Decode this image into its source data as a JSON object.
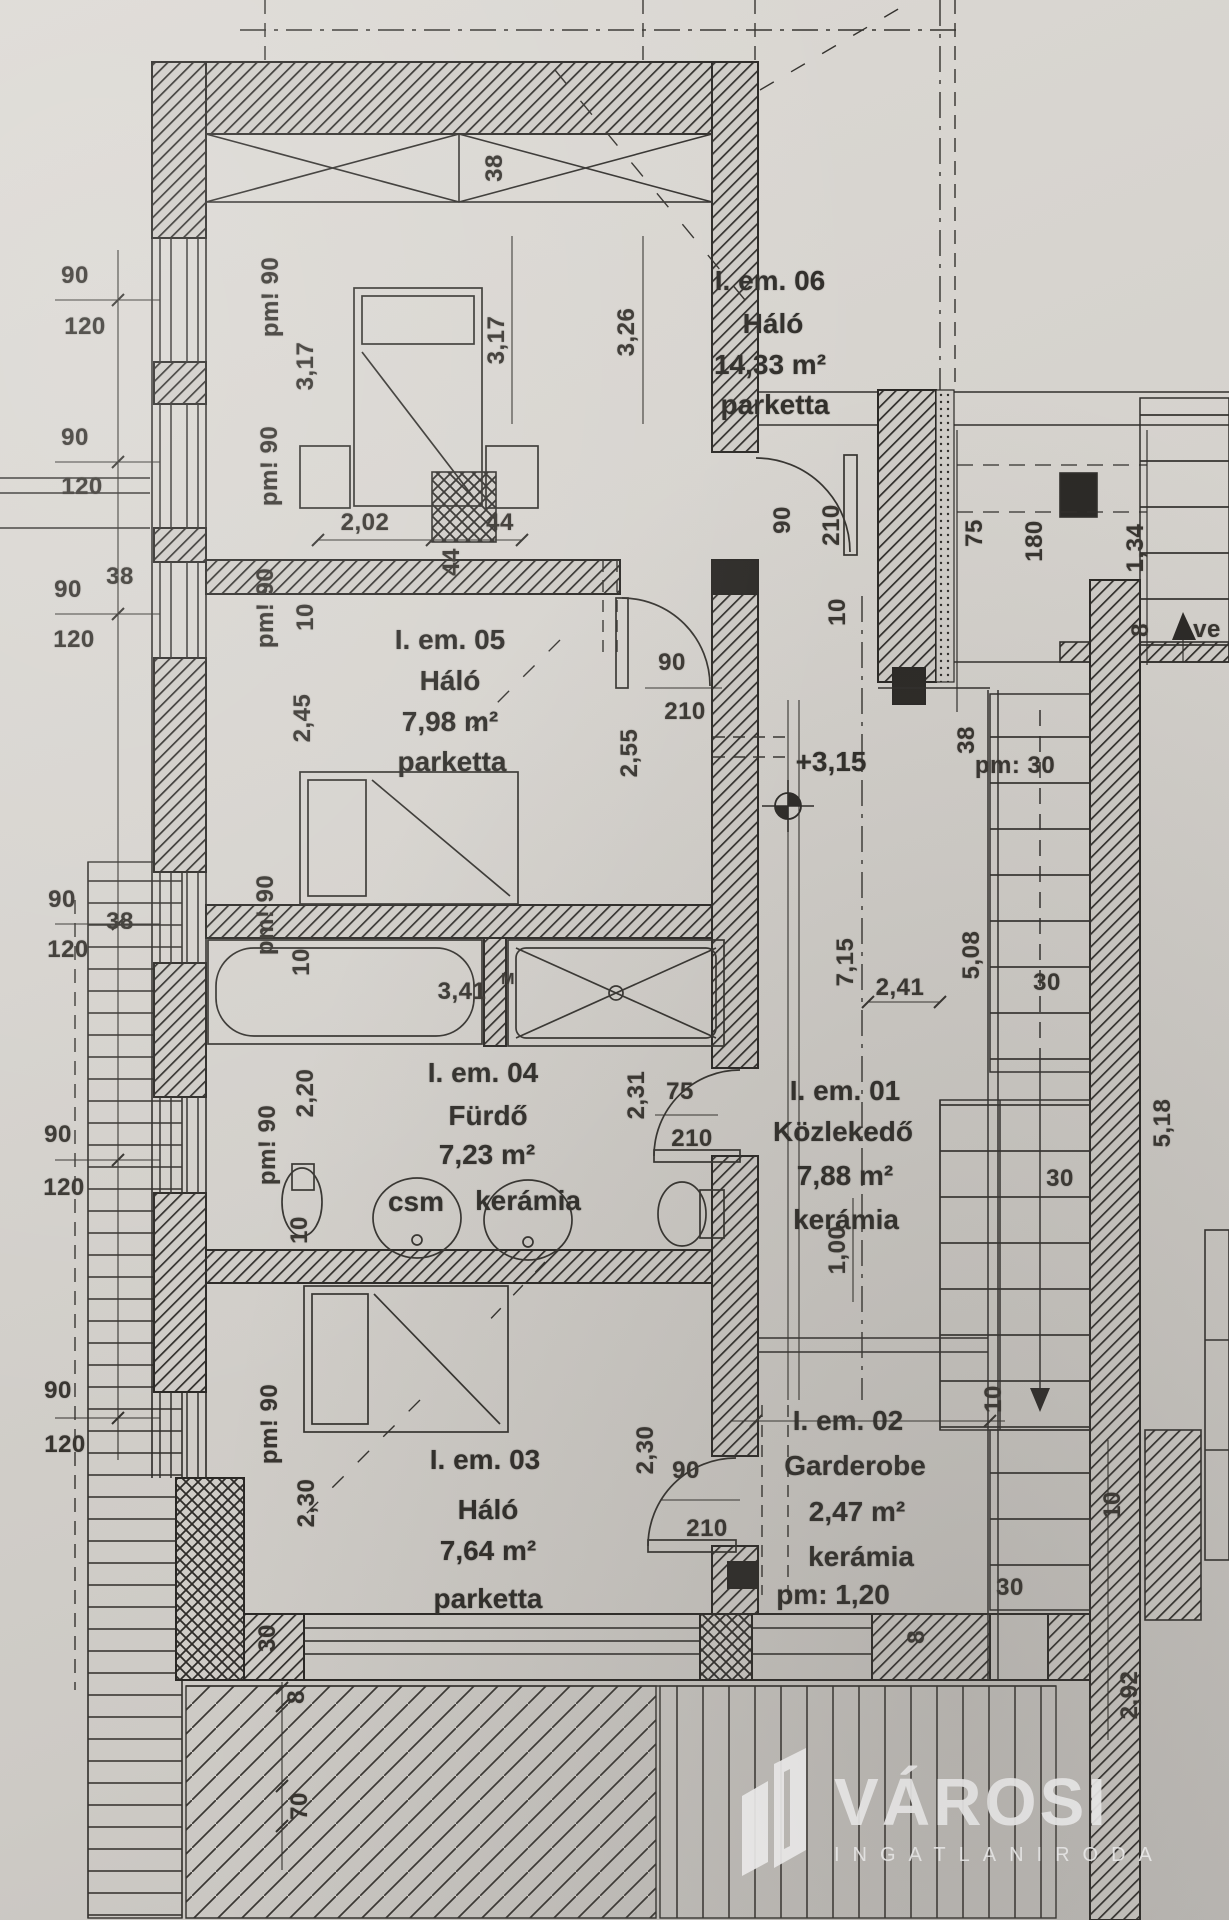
{
  "rooms": [
    {
      "id": "I. em. 06",
      "name": "Háló",
      "area": "14,33 m²",
      "floor": "parketta"
    },
    {
      "id": "I. em. 05",
      "name": "Háló",
      "area": "7,98 m²",
      "floor": "parketta"
    },
    {
      "id": "I. em. 04",
      "name": "Fürdő",
      "area": "7,23 m²",
      "floor": "kerámia",
      "fixture": "csm"
    },
    {
      "id": "I. em. 01",
      "name": "Közlekedő",
      "area": "7,88 m²",
      "floor": "kerámia"
    },
    {
      "id": "I. em. 02",
      "name": "Garderobe",
      "area": "2,47 m²",
      "floor": "kerámia",
      "note": "pm: 1,20"
    },
    {
      "id": "I. em. 03",
      "name": "Háló",
      "area": "7,64 m²",
      "floor": "parketta"
    }
  ],
  "level_mark": "+3,15",
  "dims": {
    "n8": "8",
    "n10": "10",
    "n30": "30",
    "n38": "38",
    "n44": "44",
    "n70": "70",
    "n75": "75",
    "n90": "90",
    "n120": "120",
    "n180": "180",
    "n210": "210",
    "d100": "1,00",
    "d134": "1,34",
    "d202": "2,02",
    "d220": "2,20",
    "d230": "2,30",
    "d231": "2,31",
    "d241": "2,41",
    "d245": "2,45",
    "d255": "2,55",
    "d292": "2,92",
    "d317": "3,17",
    "d326": "3,26",
    "d341": "3,41",
    "d508": "5,08",
    "d518": "5,18",
    "d715": "7,15",
    "pm90": "pm! 90",
    "pm30": "pm: 30",
    "supM": "M",
    "ve": "ve"
  },
  "watermark": {
    "brand": "VÁROSI",
    "tagline": "INGATLANIRODA"
  }
}
